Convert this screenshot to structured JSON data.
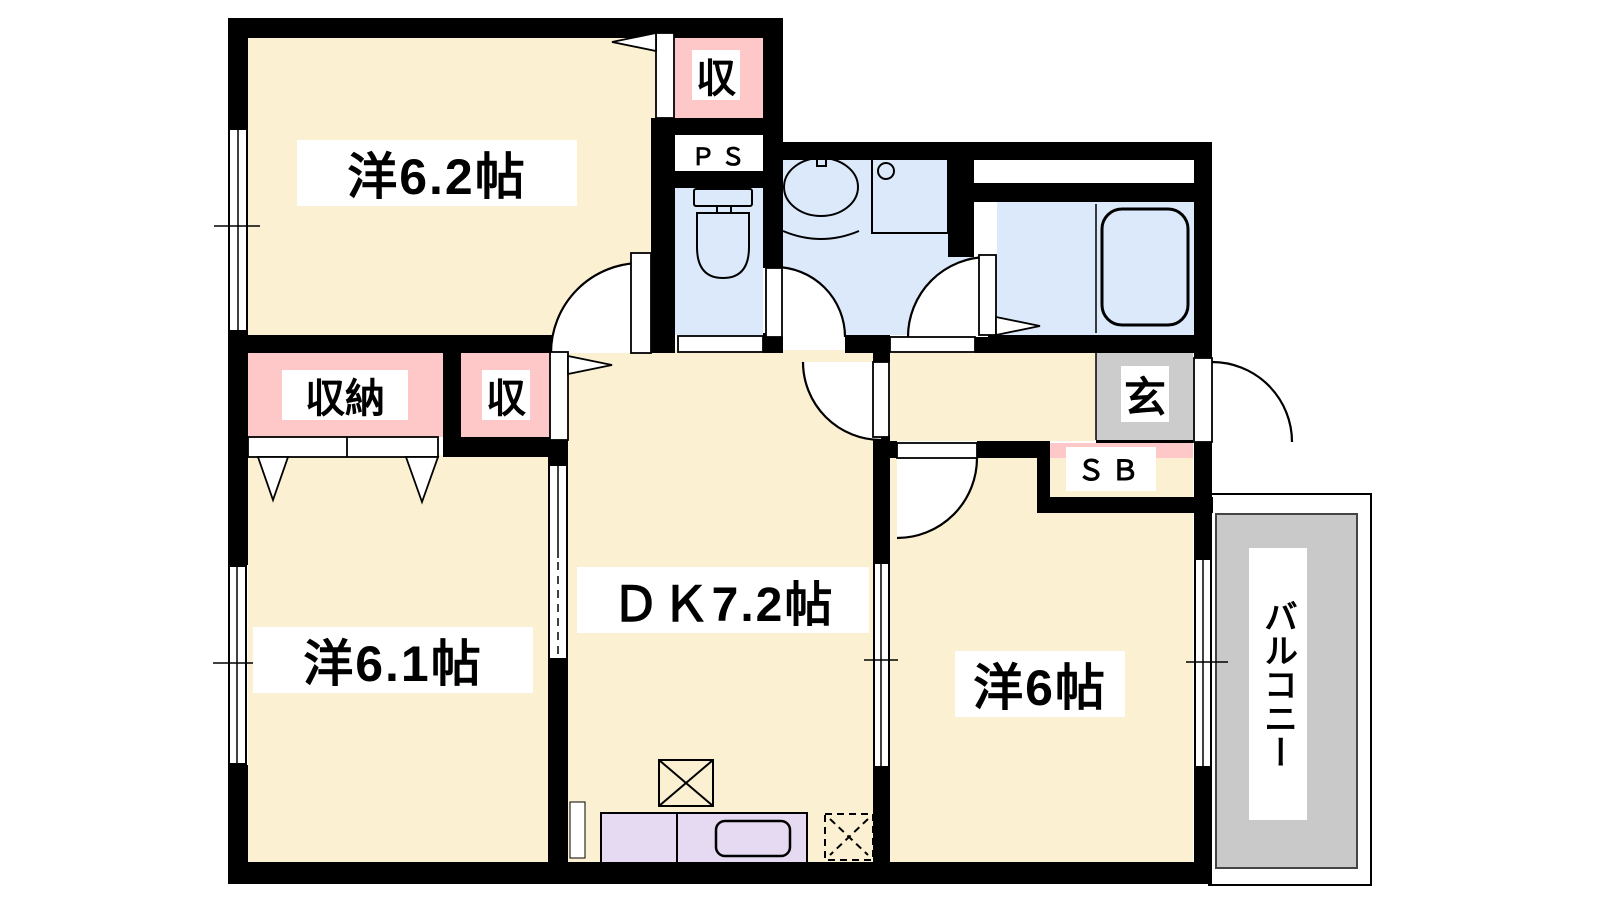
{
  "title": "マンション間取り図 2DK+バルコニー",
  "labels": {
    "room_yo62": "洋6.2帖",
    "closet_top": "収",
    "ps": "ＰＳ",
    "storage": "収納",
    "closet_mid": "収",
    "dk": "ＤＫ7.2帖",
    "room_yo61": "洋6.1帖",
    "room_yo6": "洋6帖",
    "entrance": "玄",
    "shoebox": "ＳＢ",
    "balcony": "バルコニー"
  },
  "colors": {
    "wall": "#000000",
    "room_floor_cream": "#FBF0D2",
    "closet_pink": "#FFC8C8",
    "wet_area_blue": "#DCE9FA",
    "entrance_gray": "#CCCCCC",
    "balcony_gray": "#C9C9C9",
    "kitchen_purple": "#E6D9F2",
    "label_bg": "#FFFFFF"
  }
}
